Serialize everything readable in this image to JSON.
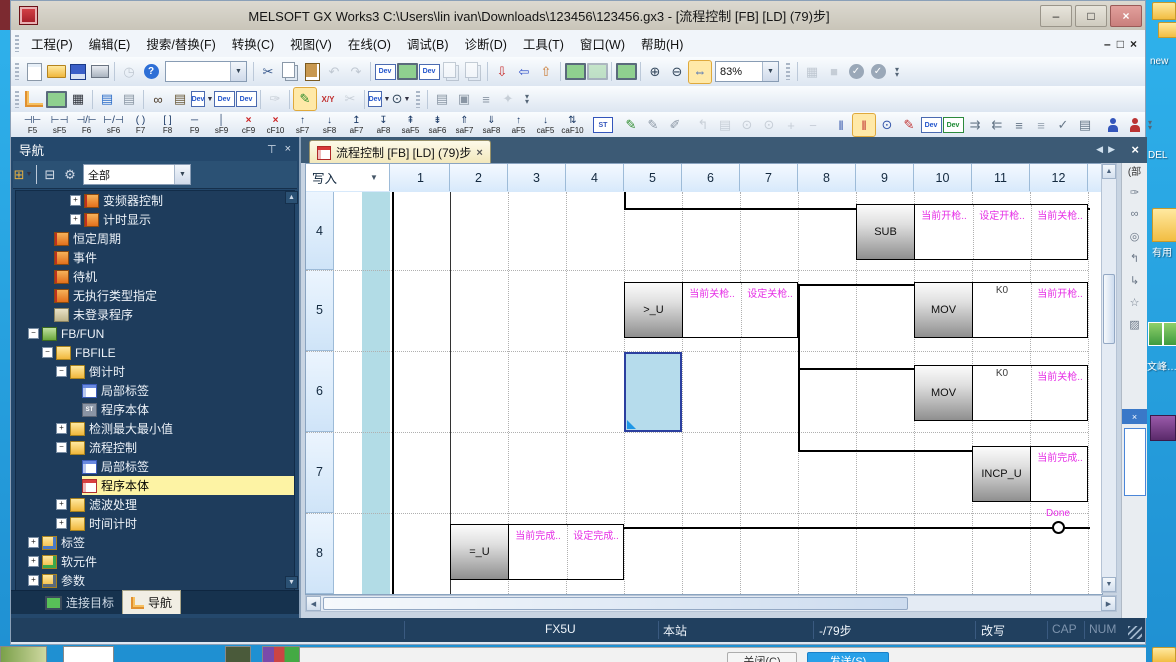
{
  "window": {
    "title": "MELSOFT GX Works3 C:\\Users\\lin ivan\\Downloads\\123456\\123456.gx3 - [流程控制 [FB] [LD] (79)步]",
    "controls": {
      "minimize": "–",
      "restore": "□",
      "close": "×"
    }
  },
  "menu": {
    "items": [
      "工程(P)",
      "编辑(E)",
      "搜索/替换(F)",
      "转换(C)",
      "视图(V)",
      "在线(O)",
      "调试(B)",
      "诊断(D)",
      "工具(T)",
      "窗口(W)",
      "帮助(H)"
    ],
    "mdi_controls": [
      "–",
      "□",
      "×"
    ]
  },
  "toolbars": {
    "row1": [
      {
        "grip": true
      },
      {
        "n": "new-project-icon",
        "kind": "page"
      },
      {
        "n": "open-project-icon",
        "kind": "folderopen"
      },
      {
        "n": "save-project-icon",
        "kind": "disk"
      },
      {
        "n": "print-icon",
        "kind": "print"
      },
      {
        "sep": true
      },
      {
        "n": "project-revision-icon",
        "g": "◷",
        "c": "#8a96a4",
        "dis": true
      },
      {
        "n": "help-icon",
        "g": "?",
        "c": "#ffffff",
        "bg": "#2e6fd6",
        "round": true
      },
      {
        "combo": {
          "n": "quick-access-combo",
          "value": "",
          "w": 80
        }
      },
      {
        "sep": true
      },
      {
        "n": "cut-icon",
        "g": "✂",
        "c": "#33558a"
      },
      {
        "n": "copy-icon",
        "kind": "copy"
      },
      {
        "n": "paste-icon",
        "kind": "paste"
      },
      {
        "n": "undo-icon",
        "g": "↶",
        "c": "#8a96a4",
        "dis": true
      },
      {
        "n": "redo-icon",
        "g": "↷",
        "c": "#8a96a4",
        "dis": true
      },
      {
        "sep": true
      },
      {
        "n": "device-comment-icon",
        "kind": "dev"
      },
      {
        "n": "ladder-monitor-icon",
        "kind": "monitor"
      },
      {
        "n": "device-memory-icon",
        "kind": "dev"
      },
      {
        "n": "screen-copy-icon",
        "kind": "copy",
        "dis": true
      },
      {
        "n": "screen-paste-icon",
        "kind": "copy",
        "dis": true
      },
      {
        "sep": true
      },
      {
        "n": "write-to-plc-icon",
        "g": "⇩",
        "c": "#c83030"
      },
      {
        "n": "read-from-plc-icon",
        "g": "⇦",
        "c": "#3050c8"
      },
      {
        "n": "online-change-icon",
        "g": "⇧",
        "c": "#c87830"
      },
      {
        "sep": true
      },
      {
        "n": "monitor-window-icon",
        "kind": "monitor"
      },
      {
        "n": "monitor-window2-icon",
        "kind": "monitor",
        "dis": true
      },
      {
        "sep": true
      },
      {
        "n": "watch-window-icon",
        "kind": "monitor"
      },
      {
        "sep": true
      },
      {
        "n": "zoom-in-icon",
        "g": "⊕",
        "c": "#33475c"
      },
      {
        "n": "zoom-out-icon",
        "g": "⊖",
        "c": "#33475c"
      },
      {
        "n": "fit-width-icon",
        "g": "⇔",
        "c": "#2255bb",
        "box": true
      },
      {
        "combo": {
          "n": "zoom-level-combo",
          "value": "83%",
          "w": 62
        }
      },
      {
        "grip": true
      },
      {
        "sep": true
      },
      {
        "n": "comment-display-icon",
        "g": "▦",
        "c": "#8a96a4",
        "dis": true
      },
      {
        "n": "stop-watch-icon",
        "g": "■",
        "c": "#9aa4b0",
        "dis": true
      },
      {
        "n": "convert-check-icon",
        "g": "✓",
        "c": "#ffffff",
        "bg": "#9aa8b8",
        "round": true
      },
      {
        "n": "convert-all-check-icon",
        "g": "✓",
        "c": "#ffffff",
        "bg": "#9aa8b8",
        "round": true
      },
      {
        "overflow": true
      }
    ],
    "row2": [
      {
        "grip": true
      },
      {
        "n": "project-tree-icon",
        "kind": "tree"
      },
      {
        "n": "module-configuration-icon",
        "kind": "monitor"
      },
      {
        "n": "unit-tool-icon",
        "g": "▦",
        "c": "#30343c"
      },
      {
        "sep": true
      },
      {
        "n": "work-window-list-icon",
        "g": "▤",
        "c": "#2b6cc8"
      },
      {
        "n": "output-window-icon",
        "g": "▤",
        "c": "#8a96a4"
      },
      {
        "sep": true
      },
      {
        "n": "find-binoculars-icon",
        "g": "∞",
        "c": "#4a3a28"
      },
      {
        "n": "cross-reference-icon",
        "g": "▤",
        "c": "#6a5a3a"
      },
      {
        "n": "device-find-icon",
        "kind": "dev",
        "dd": true
      },
      {
        "n": "device-list-icon",
        "kind": "dev"
      },
      {
        "n": "device-batch-icon",
        "kind": "dev"
      },
      {
        "sep": true
      },
      {
        "n": "comment-edit-icon",
        "g": "✑",
        "c": "#9aa4b0",
        "dis": true
      },
      {
        "sep": true
      },
      {
        "n": "edit-mode-icon",
        "g": "✎",
        "c": "#2a8a2a",
        "box": true
      },
      {
        "n": "io-monitor-icon",
        "g": "X/Y",
        "c": "#c03030",
        "small": true
      },
      {
        "n": "wire-cut-icon",
        "g": "✂",
        "c": "#9aa4b0",
        "dis": true
      },
      {
        "sep": true
      },
      {
        "n": "device-display-icon",
        "kind": "dev",
        "dd": true
      },
      {
        "n": "find-device-icon",
        "g": "⊙",
        "c": "#33475c",
        "dd": true
      },
      {
        "grip": true
      },
      {
        "sep": true
      },
      {
        "n": "statement-list-icon",
        "g": "▤",
        "c": "#8a96a4"
      },
      {
        "n": "pou-list-icon",
        "g": "▣",
        "c": "#8a96a4"
      },
      {
        "n": "display-lines-icon",
        "g": "≡",
        "c": "#8a96a4"
      },
      {
        "n": "library-icon",
        "g": "✦",
        "c": "#9aa4b0",
        "dis": true
      },
      {
        "overflow": true
      }
    ],
    "fkeys": [
      {
        "s": "⊣⊢",
        "l": "F5"
      },
      {
        "s": "⊢⊣",
        "l": "sF5"
      },
      {
        "s": "⊣/⊢",
        "l": "F6"
      },
      {
        "s": "⊢/⊣",
        "l": "sF6"
      },
      {
        "s": "( )",
        "l": "F7"
      },
      {
        "s": "[ ]",
        "l": "F8"
      },
      {
        "s": "─",
        "l": "F9"
      },
      {
        "s": "│",
        "l": "sF9"
      },
      {
        "s": "×",
        "l": "cF9",
        "red": true
      },
      {
        "s": "×",
        "l": "cF10",
        "red": true
      },
      {
        "s": "↑",
        "l": "sF7"
      },
      {
        "s": "↓",
        "l": "sF8"
      },
      {
        "s": "↥",
        "l": "aF7"
      },
      {
        "s": "↧",
        "l": "aF8"
      },
      {
        "s": "⇞",
        "l": "saF5"
      },
      {
        "s": "⇟",
        "l": "saF6"
      },
      {
        "s": "⇑",
        "l": "saF7"
      },
      {
        "s": "⇓",
        "l": "saF8"
      },
      {
        "s": "↑",
        "l": "aF5"
      },
      {
        "s": "↓",
        "l": "caF5"
      },
      {
        "s": "⇅",
        "l": "caF10"
      }
    ],
    "row3_extra": [
      {
        "sep": true
      },
      {
        "n": "st-inline-icon",
        "kind": "st"
      },
      {
        "sep": true
      },
      {
        "n": "draw-line-icon",
        "g": "✎",
        "c": "#2a8a2a"
      },
      {
        "n": "delete-line-icon",
        "g": "✎",
        "c": "#8a96a4"
      },
      {
        "n": "input-instruction-icon",
        "g": "✐",
        "c": "#8a96a4"
      },
      {
        "sep": true
      },
      {
        "n": "jump-icon",
        "g": "↰",
        "c": "#9aa4b0",
        "dis": true
      },
      {
        "n": "document-icon",
        "g": "▤",
        "c": "#9aa4b0",
        "dis": true
      },
      {
        "n": "find-contact-icon",
        "g": "⊙",
        "c": "#9aa4b0",
        "dis": true
      },
      {
        "n": "find-coil-icon",
        "g": "⊙",
        "c": "#9aa4b0",
        "dis": true
      },
      {
        "n": "insert-row-icon",
        "g": "+",
        "c": "#9aa4b0",
        "dis": true
      },
      {
        "n": "delete-row-icon",
        "g": "−",
        "c": "#9aa4b0",
        "dis": true
      },
      {
        "sep": true
      },
      {
        "n": "rail-display-icon",
        "g": "‖",
        "c": "#3355aa"
      },
      {
        "n": "rail-edit-icon",
        "g": "‖",
        "c": "#c03030",
        "box": true
      },
      {
        "n": "find-doc-icon",
        "g": "⊙",
        "c": "#3355aa"
      },
      {
        "n": "edit-doc-icon",
        "g": "✎",
        "c": "#c03030"
      },
      {
        "n": "device-check-icon",
        "kind": "dev"
      },
      {
        "n": "device-skip-icon",
        "kind": "dev2"
      },
      {
        "n": "indent-right-icon",
        "g": "⇉",
        "c": "#667788"
      },
      {
        "n": "indent-left-icon",
        "g": "⇇",
        "c": "#667788"
      },
      {
        "n": "align-lines-icon",
        "g": "≡",
        "c": "#667788"
      },
      {
        "n": "align-lines2-icon",
        "g": "≡",
        "c": "#99a6b2"
      },
      {
        "n": "list-check-icon",
        "g": "✓",
        "c": "#667788"
      },
      {
        "n": "list-ref-icon",
        "g": "▤",
        "c": "#667788"
      },
      {
        "sep": true
      },
      {
        "n": "user-web-icon",
        "kind": "person",
        "c": "#3355bb"
      },
      {
        "n": "user-support-icon",
        "kind": "person",
        "c": "#bb3333"
      },
      {
        "overflow": true
      }
    ]
  },
  "nav": {
    "title": "导航",
    "toolbar": [
      {
        "n": "tree-module-icon",
        "g": "⊞",
        "c": "#e8b040",
        "dd": true
      },
      {
        "sep": true
      },
      {
        "n": "collapse-tree-icon",
        "g": "⊟",
        "c": "#d8dee8"
      },
      {
        "n": "option-gear-icon",
        "g": "⚙",
        "c": "#d0d8e4"
      },
      {
        "combo": {
          "n": "tree-filter-combo",
          "value": "全部",
          "w": 106
        }
      }
    ],
    "tabs": [
      {
        "label": "连接目标",
        "active": false
      },
      {
        "label": "导航",
        "active": true
      }
    ],
    "tree": [
      {
        "level": 5,
        "exp": "+",
        "icon": "pgm",
        "label": "变频器控制"
      },
      {
        "level": 5,
        "exp": "+",
        "icon": "pgm",
        "label": "计时显示"
      },
      {
        "level": 3,
        "icon": "pgm",
        "label": "恒定周期"
      },
      {
        "level": 3,
        "icon": "pgm",
        "label": "事件"
      },
      {
        "level": 3,
        "icon": "pgm",
        "label": "待机"
      },
      {
        "level": 3,
        "icon": "pgm",
        "label": "无执行类型指定"
      },
      {
        "level": 3,
        "icon": "foldergrey",
        "label": "未登录程序"
      },
      {
        "level": 2,
        "exp": "-",
        "icon": "folderg",
        "label": "FB/FUN"
      },
      {
        "level": 3,
        "exp": "-",
        "icon": "folder",
        "label": "FBFILE"
      },
      {
        "level": 4,
        "exp": "-",
        "icon": "folder",
        "label": "倒计时"
      },
      {
        "level": 5,
        "icon": "table",
        "label": "局部标签"
      },
      {
        "level": 5,
        "icon": "st",
        "label": "程序本体"
      },
      {
        "level": 4,
        "exp": "+",
        "icon": "folder",
        "label": "检测最大最小值"
      },
      {
        "level": 4,
        "exp": "-",
        "icon": "folder",
        "label": "流程控制"
      },
      {
        "level": 5,
        "icon": "table",
        "label": "局部标签"
      },
      {
        "level": 5,
        "icon": "ld",
        "label": "程序本体",
        "selected": true
      },
      {
        "level": 4,
        "exp": "+",
        "icon": "folder",
        "label": "滤波处理"
      },
      {
        "level": 4,
        "exp": "+",
        "icon": "folder",
        "label": "时间计时"
      },
      {
        "level": 2,
        "exp": "+",
        "icon": "folderb",
        "label": "标签"
      },
      {
        "level": 2,
        "exp": "+",
        "icon": "folderd",
        "label": "软元件"
      },
      {
        "level": 2,
        "exp": "+",
        "icon": "folderp",
        "label": "参数"
      }
    ]
  },
  "editor": {
    "tab_title": "流程控制 [FB] [LD] (79)步",
    "tab_close": "×",
    "mode": "写入",
    "columns": [
      "1",
      "2",
      "3",
      "4",
      "5",
      "6",
      "7",
      "8",
      "9",
      "10",
      "11",
      "12"
    ],
    "row_numbers": [
      "4",
      "5",
      "6",
      "7",
      "8"
    ],
    "ladder": {
      "rail_x": 86,
      "solid_col_x": 144,
      "dotted_cols": [
        202,
        260,
        318,
        376,
        434,
        492,
        550,
        608,
        666,
        724,
        782
      ],
      "dotted_rows": [
        78,
        159,
        240,
        321,
        402
      ],
      "wires": [
        {
          "dir": "v",
          "x": 318,
          "y": 0,
          "len": 18
        },
        {
          "dir": "h",
          "x": 318,
          "y": 16,
          "len": 466
        },
        {
          "dir": "h",
          "x": 492,
          "y": 92,
          "len": 118
        },
        {
          "dir": "v",
          "x": 492,
          "y": 92,
          "len": 168
        },
        {
          "dir": "h",
          "x": 492,
          "y": 176,
          "len": 118
        },
        {
          "dir": "h",
          "x": 492,
          "y": 258,
          "len": 176
        },
        {
          "dir": "h",
          "x": 318,
          "y": 335,
          "len": 466
        }
      ],
      "regions": [
        {
          "x": 550,
          "y": 12,
          "block": "SUB",
          "cells": [
            {
              "t": "当前开枪..",
              "k": "pin"
            },
            {
              "t": "设定开枪..",
              "k": "pin"
            },
            {
              "t": "当前关枪..",
              "k": "pin"
            }
          ]
        },
        {
          "x": 318,
          "y": 90,
          "block": ">_U",
          "cells": [
            {
              "t": "当前关枪..",
              "k": "pin"
            },
            {
              "t": "设定关枪..",
              "k": "pin"
            }
          ]
        },
        {
          "x": 608,
          "y": 90,
          "block": "MOV",
          "cells": [
            {
              "t": "K0",
              "k": "op"
            },
            {
              "t": "当前开枪..",
              "k": "pin"
            }
          ]
        },
        {
          "x": 608,
          "y": 173,
          "block": "MOV",
          "cells": [
            {
              "t": "K0",
              "k": "op"
            },
            {
              "t": "当前关枪..",
              "k": "pin"
            }
          ]
        },
        {
          "x": 666,
          "y": 254,
          "block": "INCP_U",
          "cells": [
            {
              "t": "当前完成..",
              "k": "pin"
            }
          ]
        },
        {
          "x": 144,
          "y": 332,
          "block": "=_U",
          "cells": [
            {
              "t": "当前完成..",
              "k": "pin"
            },
            {
              "t": "设定完成..",
              "k": "pin"
            }
          ]
        }
      ],
      "coil": {
        "cx": 752,
        "cy": 335,
        "label": "Done"
      },
      "selected_cell": {
        "x": 318,
        "y": 160,
        "w": 58,
        "h": 80
      }
    }
  },
  "statusbar": {
    "cpu": "FX5U",
    "host": "本站",
    "steps": "-/79步",
    "edit_mode": "改写",
    "cap": "CAP",
    "num": "NUM"
  },
  "right_dock": {
    "title_fragment": "(部",
    "close": "×",
    "icons": [
      {
        "n": "stamp-icon",
        "g": "✑"
      },
      {
        "n": "binoculars-icon",
        "g": "∞"
      },
      {
        "n": "browse-icon",
        "g": "◎"
      },
      {
        "n": "jump-back-icon",
        "g": "↰"
      },
      {
        "n": "jump-forward-icon",
        "g": "↳"
      },
      {
        "n": "favorites-star-icon",
        "g": "☆"
      },
      {
        "n": "folder-close-icon",
        "g": "▨"
      }
    ]
  },
  "desktop": {
    "labels": {
      "new_partial": "new",
      "del": "DEL",
      "useful": "有用",
      "wenfeng": "文峰…"
    }
  },
  "bottom_bar": {
    "close_button": "关闭(C)",
    "send_button": "发送(S)"
  }
}
